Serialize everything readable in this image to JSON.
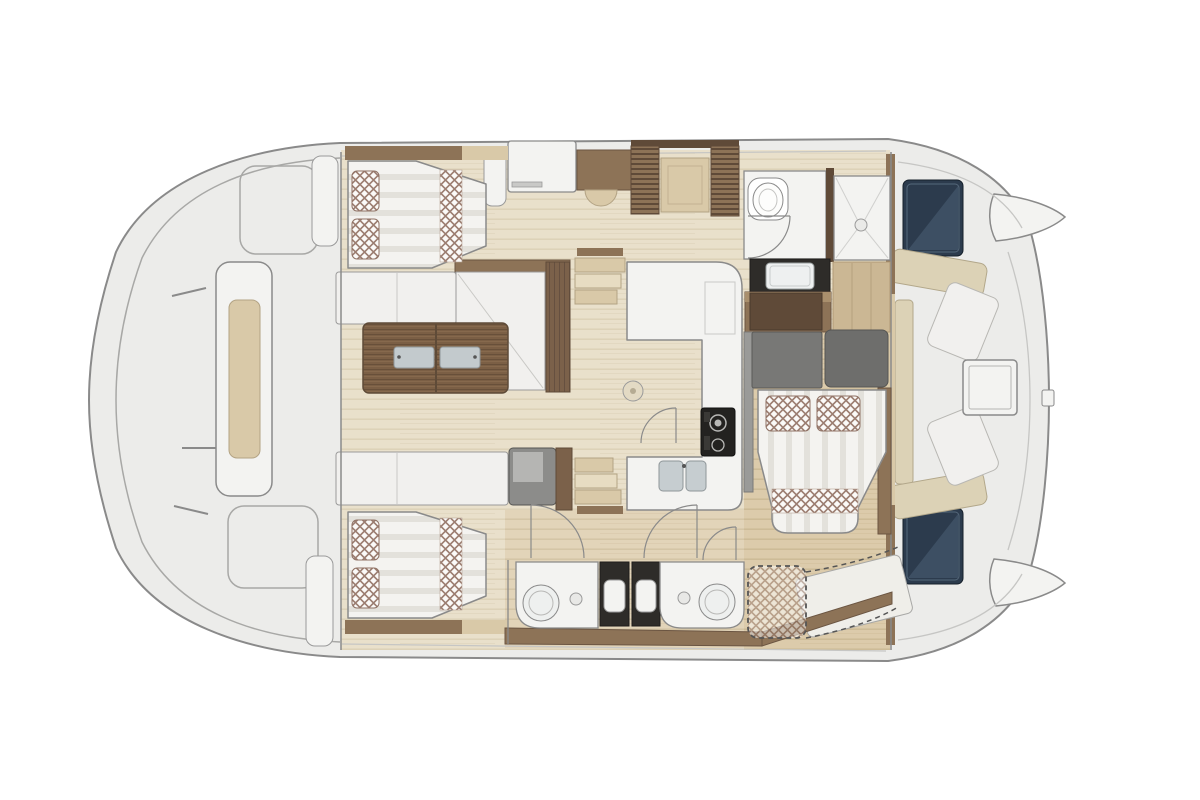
{
  "meta": {
    "type": "catamaran-floor-plan",
    "view": "overhead interior and deck layout plan",
    "axis": "horizontal",
    "visible_text": ""
  },
  "palette": {
    "bg": "#ffffff",
    "outline": "#8a8a8a",
    "deck": "#ececea",
    "deck-line": "#c6c6c4",
    "floor-light": "#e9e0cb",
    "floor-dark": "#dccbab",
    "panel-white": "#f3f3f1",
    "cushion-white": "#f1f0ee",
    "wood-dark": "#5f4a38",
    "wood-mid": "#8d7357",
    "wood-table": "#7b5f45",
    "trim-beige": "#d9c9a8",
    "plank-beige": "#cbb794",
    "checker": "#9c7e71",
    "grey-panel": "#787876",
    "grey-box": "#8c8c8a",
    "dark-counter": "#2e2c29",
    "hatch-navy": "#2c3b4d",
    "hatch-navy-light": "#44586c",
    "steel": "#c6cdd0",
    "cockpit-beige": "#dcd2b6"
  },
  "regions": [
    {
      "id": "foredeck",
      "label": "forward deck with center locker"
    },
    {
      "id": "cabin-port-fwd",
      "label": "port forward cabin, double berth"
    },
    {
      "id": "cabin-stbd-fwd",
      "label": "starboard forward cabin, double berth"
    },
    {
      "id": "saloon",
      "label": "saloon L-sofa with folding wood table"
    },
    {
      "id": "galley",
      "label": "U-shaped galley with stove and twin sink"
    },
    {
      "id": "wardrobe",
      "label": "louvered wardrobes"
    },
    {
      "id": "head-wc",
      "label": "toilet compartment"
    },
    {
      "id": "shower",
      "label": "separate shower"
    },
    {
      "id": "vanity-head",
      "label": "washbasin in dark counter"
    },
    {
      "id": "cabin-aft",
      "label": "aft double cabin with desk"
    },
    {
      "id": "bathroom-port",
      "label": "lower bathroom with round basin (left)"
    },
    {
      "id": "bathroom-stbd",
      "label": "lower bathroom with round basin (right)"
    },
    {
      "id": "optional-berth",
      "label": "dashed optional berth / conversion"
    },
    {
      "id": "cockpit",
      "label": "aft cockpit lounge with table"
    },
    {
      "id": "engine-hatches",
      "label": "two navy deck hatches"
    },
    {
      "id": "transom-tips",
      "label": "twin hull transom points"
    }
  ]
}
